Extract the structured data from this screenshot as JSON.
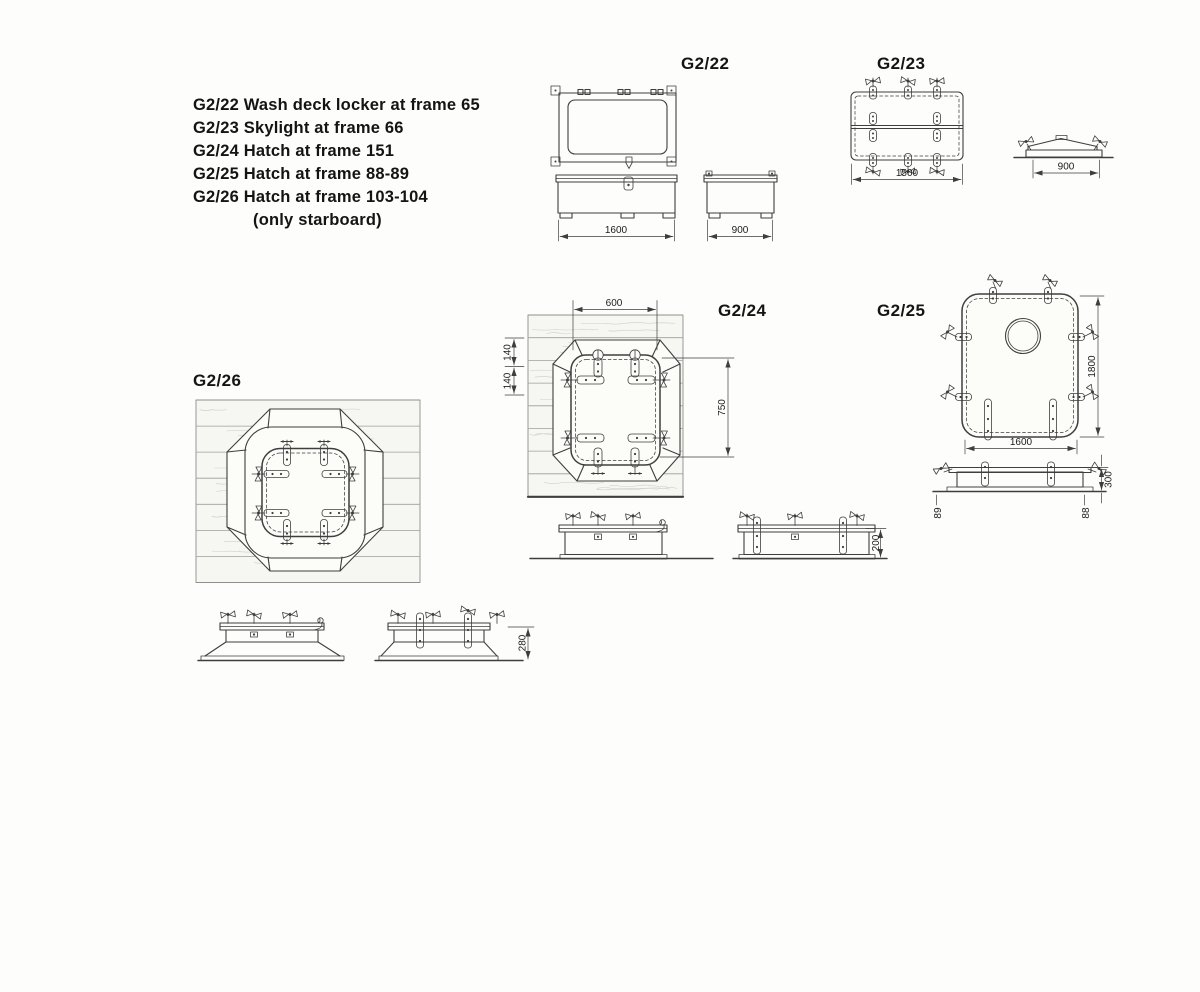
{
  "legend": {
    "lines": [
      "G2/22 Wash deck locker at frame 65",
      "G2/23 Skylight at frame 66",
      "G2/24 Hatch at frame 151",
      "G2/25 Hatch at frame 88-89",
      "G2/26 Hatch at frame 103-104"
    ],
    "note": "(only starboard)"
  },
  "figures": {
    "g22": {
      "label": "G2/22",
      "dims": {
        "width": "1600",
        "depth": "900"
      }
    },
    "g23": {
      "label": "G2/23",
      "dims": {
        "width": "1500",
        "depth": "900"
      }
    },
    "g24": {
      "label": "G2/24",
      "dims": {
        "opening_width": "600",
        "plank_a": "140",
        "plank_b": "140",
        "opening_height": "750",
        "coaming_height": "200"
      }
    },
    "g25": {
      "label": "G2/25",
      "dims": {
        "width": "1600",
        "height": "1800",
        "coaming_height": "300",
        "frame_left": "89",
        "frame_right": "88"
      }
    },
    "g26": {
      "label": "G2/26",
      "dims": {
        "coaming_height": "280"
      }
    }
  }
}
